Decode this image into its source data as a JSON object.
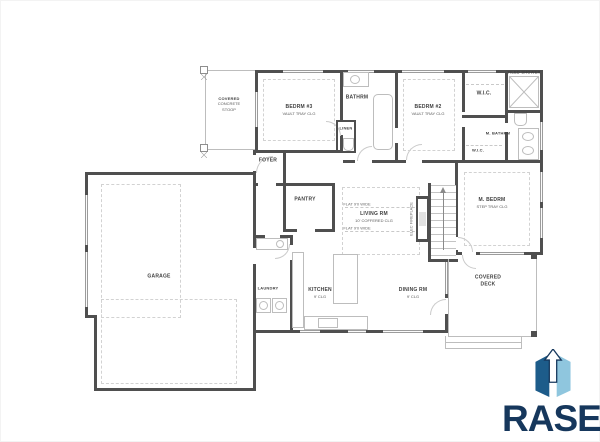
{
  "sheet": {
    "background": "#ffffff"
  },
  "floor_plan": {
    "colors": {
      "wall": "#4f4f4f",
      "thin_line": "#bdbdbd",
      "dashed_line": "#d2d2d2",
      "label_text": "#3f3f3f"
    },
    "rooms": {
      "covered_stoop": {
        "line1": "COVERED",
        "line2": "CONCRETE",
        "line3": "STOOP"
      },
      "bedrm3": {
        "label": "BEDRM #3",
        "sub": "VAULT TRAY CLG"
      },
      "bathrm": {
        "label": "BATHRM"
      },
      "linen": {
        "label": "LINEN"
      },
      "bedrm2": {
        "label": "BEDRM #2",
        "sub": "VAULT TRAY CLG"
      },
      "wic1": {
        "label": "W.I.C."
      },
      "tiled_shower": {
        "label": "TILED SHOWER"
      },
      "m_bathrm": {
        "label": "M. BATHRM"
      },
      "wic2": {
        "label": "W.I.C."
      },
      "foyer": {
        "label": "FOYER"
      },
      "pantry": {
        "label": "PANTRY"
      },
      "living_rm": {
        "label": "LIVING RM",
        "sub": "10' COFFERED CLG"
      },
      "flat_note_top": "FLAT 9'0 WIDE",
      "flat_note_bottom": "FLAT 9'0 WIDE",
      "elec_fireplace": {
        "label": "ELEC FIREPLACE"
      },
      "m_bedrm": {
        "label": "M. BEDRM",
        "sub": "STEP TRAY CLG"
      },
      "garage": {
        "label": "GARAGE"
      },
      "laundry": {
        "label": "LAUNDRY"
      },
      "kitchen": {
        "label": "KITCHEN",
        "sub": "9' CLG"
      },
      "dining_rm": {
        "label": "DINING RM",
        "sub": "9' CLG"
      },
      "covered_deck": {
        "line1": "COVERED",
        "line2": "DECK"
      }
    }
  },
  "logo": {
    "text": "RASE",
    "text_color": "#16375c",
    "box_dark_color": "#1d5c8a",
    "box_light_color": "#8fc6de"
  }
}
